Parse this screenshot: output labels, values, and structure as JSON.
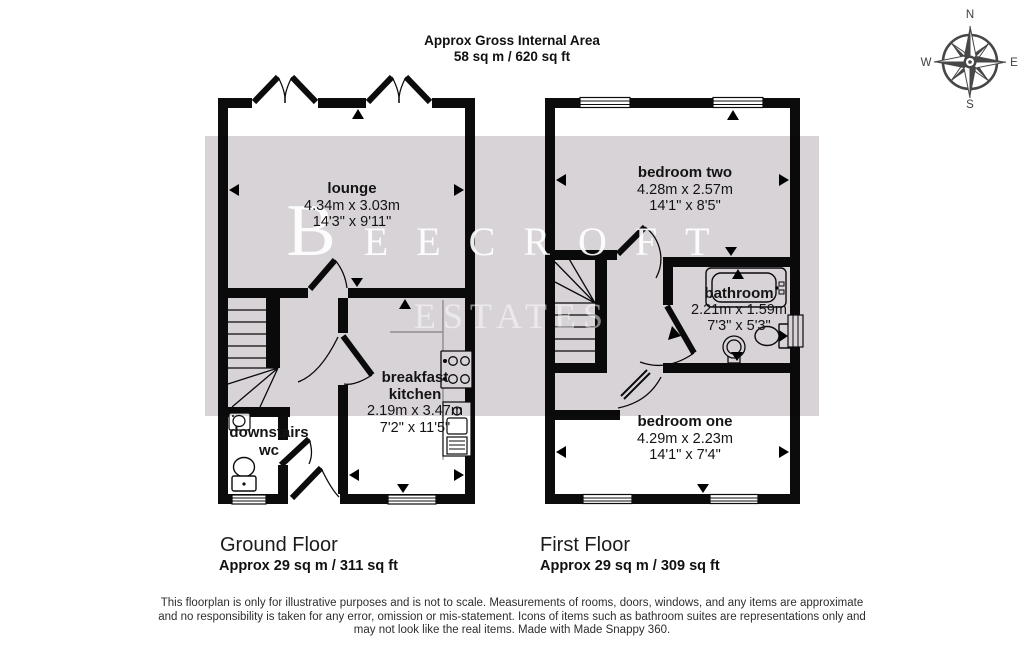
{
  "header": {
    "title": "Approx Gross Internal Area",
    "area": "58 sq m / 620 sq ft"
  },
  "compass": {
    "n": "N",
    "e": "E",
    "s": "S",
    "w": "W"
  },
  "watermark": {
    "brand": "BEECROFT",
    "sub": "ESTATES"
  },
  "ground_floor": {
    "title": "Ground Floor",
    "area": "Approx 29 sq m / 311 sq ft",
    "rooms": {
      "lounge": {
        "name": "lounge",
        "metric": "4.34m x 3.03m",
        "imperial": "14'3\" x 9'11\""
      },
      "kitchen": {
        "name_line1": "breakfast",
        "name_line2": "kitchen",
        "metric": "2.19m x 3.47m",
        "imperial": "7'2\" x 11'5\""
      },
      "wc": {
        "name_line1": "downstairs",
        "name_line2": "wc"
      }
    }
  },
  "first_floor": {
    "title": "First Floor",
    "area": "Approx 29 sq m / 309 sq ft",
    "rooms": {
      "bedroom_two": {
        "name": "bedroom two",
        "metric": "4.28m x 2.57m",
        "imperial": "14'1\" x 8'5\""
      },
      "bathroom": {
        "name": "bathroom",
        "metric": "2.21m x 1.59m",
        "imperial": "7'3\" x 5'3\""
      },
      "bedroom_one": {
        "name": "bedroom one",
        "metric": "4.29m x 2.23m",
        "imperial": "14'1\" x 7'4\""
      }
    }
  },
  "footer": {
    "line1": "This floorplan is only for illustrative purposes and is not to scale. Measurements of rooms, doors, windows, and any items are approximate",
    "line2": "and no responsibility is taken for any error, omission or mis-statement. Icons of items such as bathroom suites are representations only and",
    "line3": "may not look like the real items. Made with Made Snappy 360."
  },
  "colors": {
    "wall": "#0c0c0c",
    "watermark_band": "#d8d3d7",
    "compass": "#474747"
  }
}
